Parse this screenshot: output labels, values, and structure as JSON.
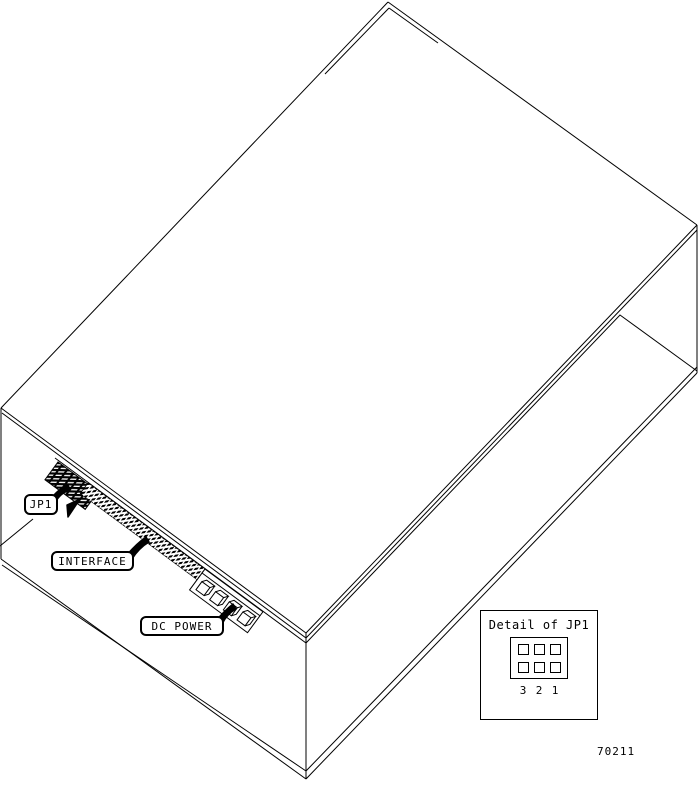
{
  "figure_number": "70211",
  "callouts": {
    "jp1": {
      "label": "JP1"
    },
    "interface": {
      "label": "INTERFACE"
    },
    "dc_power": {
      "label": "DC POWER"
    }
  },
  "detail_inset": {
    "title": "Detail of JP1",
    "pin_labels": [
      "3",
      "2",
      "1"
    ]
  },
  "colors": {
    "line": "#000000",
    "background": "#ffffff"
  }
}
